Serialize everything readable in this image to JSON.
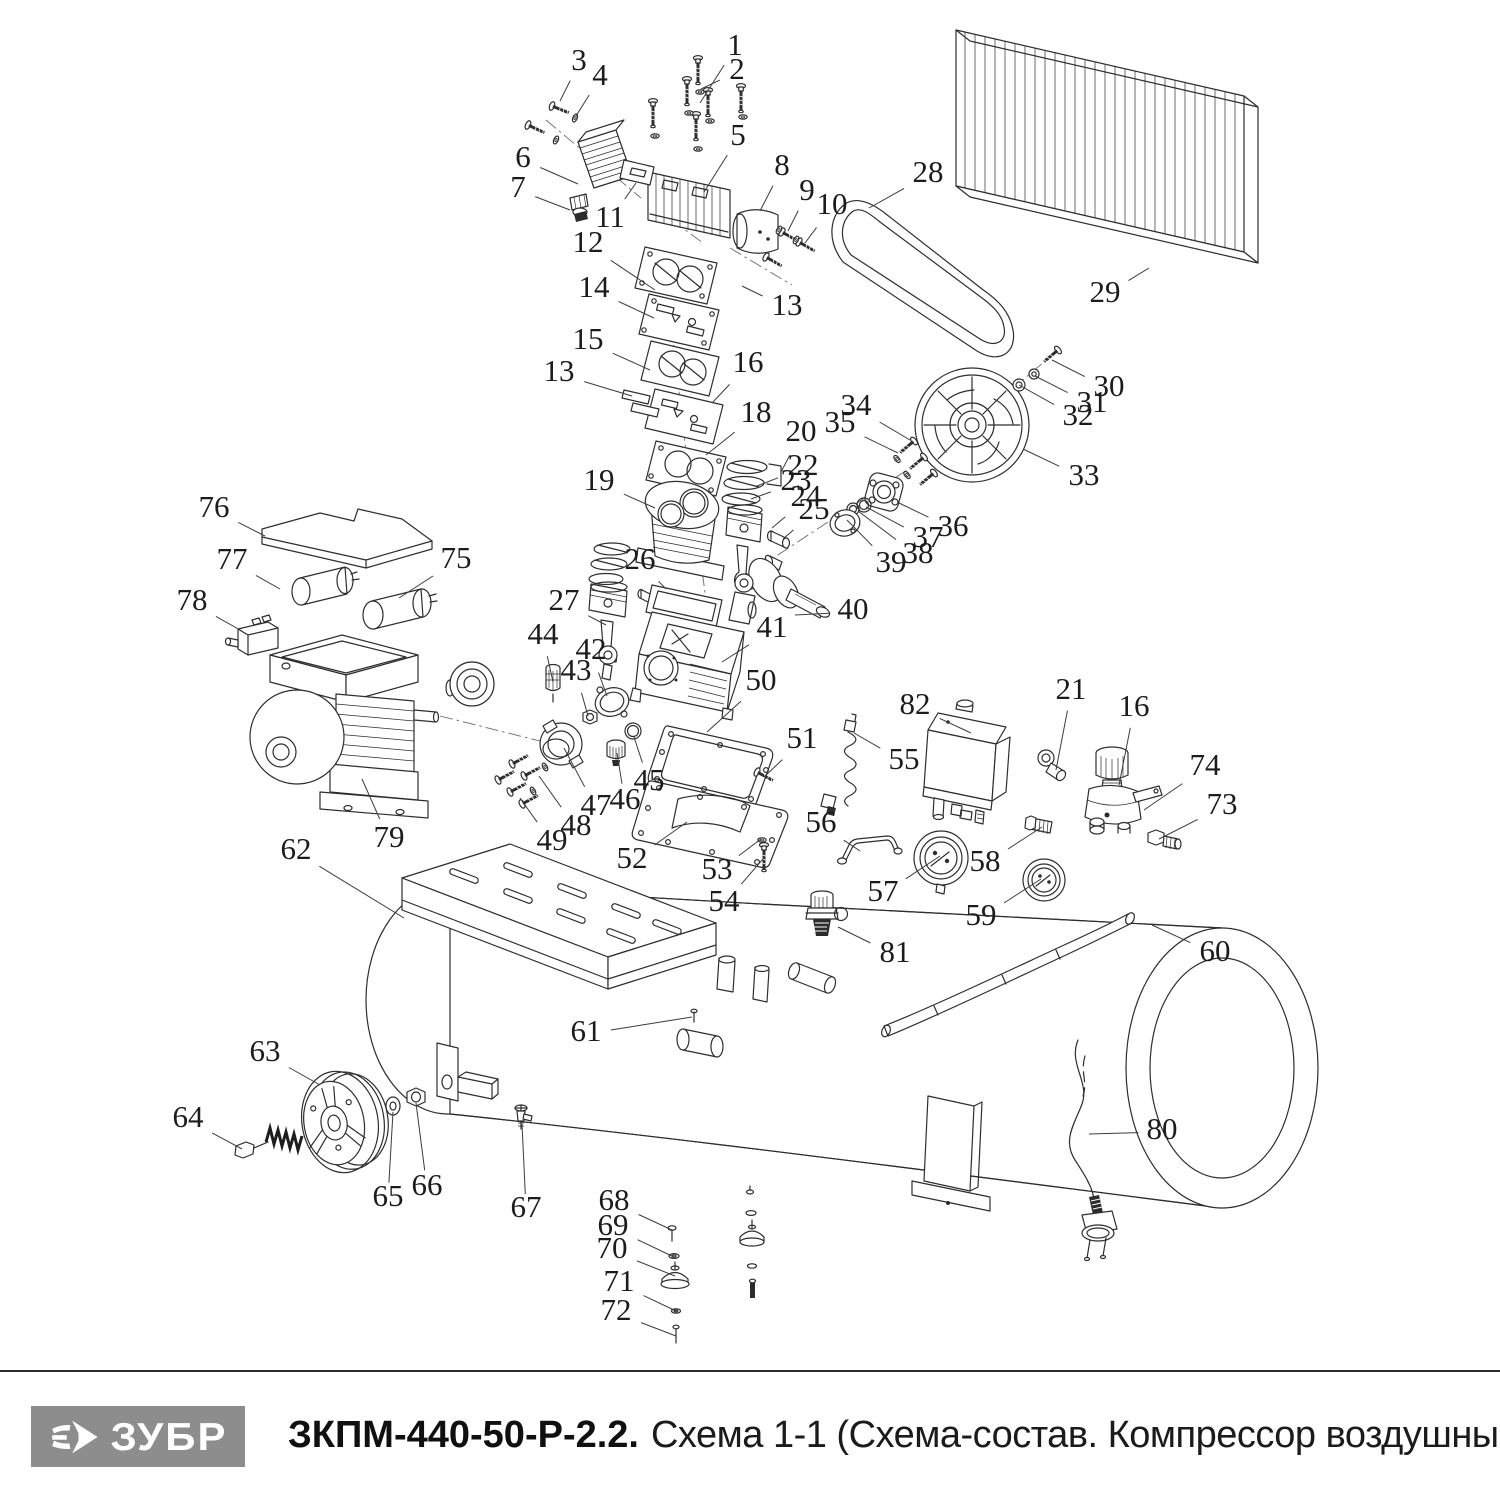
{
  "footer": {
    "brand": "ЗУБР",
    "model": "ЗКПМ-440-50-Р-2.2.",
    "subtitle": "Схема 1-1 (Схема-состав. Компрессор воздушный)",
    "brand_bg": "#8d8d8d",
    "divider_color": "#2b2b2b"
  },
  "diagram": {
    "ink": "#2e2e2e",
    "label_color": "#1c1c1c",
    "label_font_size": 31,
    "labels": [
      {
        "n": "1",
        "x": 735,
        "y": 48,
        "ax": 700,
        "ay": 103
      },
      {
        "n": "2",
        "x": 737,
        "y": 72,
        "ax": 701,
        "ay": 89
      },
      {
        "n": "3",
        "x": 579,
        "y": 63,
        "ax": 560,
        "ay": 101
      },
      {
        "n": "4",
        "x": 600,
        "y": 78,
        "ax": 576,
        "ay": 116
      },
      {
        "n": "5",
        "x": 738,
        "y": 138,
        "ax": 704,
        "ay": 192
      },
      {
        "n": "6",
        "x": 523,
        "y": 160,
        "ax": 578,
        "ay": 184
      },
      {
        "n": "7",
        "x": 518,
        "y": 190,
        "ax": 570,
        "ay": 210
      },
      {
        "n": "8",
        "x": 782,
        "y": 168,
        "ax": 760,
        "ay": 211
      },
      {
        "n": "9",
        "x": 807,
        "y": 193,
        "ax": 788,
        "ay": 231
      },
      {
        "n": "10",
        "x": 832,
        "y": 207,
        "ax": 805,
        "ay": 243
      },
      {
        "n": "11",
        "x": 610,
        "y": 220,
        "ax": 636,
        "ay": 183
      },
      {
        "n": "12",
        "x": 588,
        "y": 245,
        "ax": 655,
        "ay": 290
      },
      {
        "n": "13",
        "x": 787,
        "y": 308,
        "ax": 742,
        "ay": 286
      },
      {
        "n": "14",
        "x": 594,
        "y": 290,
        "ax": 654,
        "ay": 318
      },
      {
        "n": "15",
        "x": 588,
        "y": 342,
        "ax": 650,
        "ay": 370
      },
      {
        "n": "16",
        "x": 748,
        "y": 365,
        "ax": 712,
        "ay": 403
      },
      {
        "n": "13",
        "x": 559,
        "y": 374,
        "ax": 632,
        "ay": 396
      },
      {
        "n": "18",
        "x": 756,
        "y": 415,
        "ax": 706,
        "ay": 455
      },
      {
        "n": "19",
        "x": 599,
        "y": 483,
        "ax": 655,
        "ay": 508
      },
      {
        "n": "20",
        "x": 801,
        "y": 434,
        "ax": 781,
        "ay": 472
      },
      {
        "n": "22",
        "x": 803,
        "y": 468,
        "ax": 757,
        "ay": 486
      },
      {
        "n": "23",
        "x": 796,
        "y": 483,
        "ax": 751,
        "ay": 499
      },
      {
        "n": "24",
        "x": 806,
        "y": 499,
        "ax": 772,
        "ay": 528
      },
      {
        "n": "25",
        "x": 814,
        "y": 512,
        "ax": 783,
        "ay": 539
      },
      {
        "n": "26",
        "x": 640,
        "y": 562,
        "ax": 666,
        "ay": 589
      },
      {
        "n": "27",
        "x": 564,
        "y": 603,
        "ax": 606,
        "ay": 625
      },
      {
        "n": "28",
        "x": 928,
        "y": 175,
        "ax": 869,
        "ay": 208
      },
      {
        "n": "29",
        "x": 1105,
        "y": 295,
        "ax": 1149,
        "ay": 268
      },
      {
        "n": "30",
        "x": 1109,
        "y": 389,
        "ax": 1052,
        "ay": 360
      },
      {
        "n": "31",
        "x": 1092,
        "y": 405,
        "ax": 1035,
        "ay": 376
      },
      {
        "n": "32",
        "x": 1078,
        "y": 418,
        "ax": 1019,
        "ay": 385
      },
      {
        "n": "33",
        "x": 1084,
        "y": 478,
        "ax": 1023,
        "ay": 449
      },
      {
        "n": "34",
        "x": 856,
        "y": 408,
        "ax": 910,
        "ay": 440
      },
      {
        "n": "35",
        "x": 840,
        "y": 425,
        "ax": 898,
        "ay": 453
      },
      {
        "n": "36",
        "x": 953,
        "y": 529,
        "ax": 899,
        "ay": 503
      },
      {
        "n": "37",
        "x": 928,
        "y": 540,
        "ax": 866,
        "ay": 507
      },
      {
        "n": "38",
        "x": 918,
        "y": 556,
        "ax": 858,
        "ay": 511
      },
      {
        "n": "39",
        "x": 891,
        "y": 565,
        "ax": 847,
        "ay": 520
      },
      {
        "n": "40",
        "x": 853,
        "y": 612,
        "ax": 795,
        "ay": 615
      },
      {
        "n": "41",
        "x": 772,
        "y": 630,
        "ax": 722,
        "ay": 662
      },
      {
        "n": "42",
        "x": 591,
        "y": 652,
        "ax": 607,
        "ay": 696
      },
      {
        "n": "43",
        "x": 576,
        "y": 673,
        "ax": 588,
        "ay": 716
      },
      {
        "n": "44",
        "x": 543,
        "y": 637,
        "ax": 553,
        "ay": 682
      },
      {
        "n": "45",
        "x": 649,
        "y": 783,
        "ax": 634,
        "ay": 737
      },
      {
        "n": "46",
        "x": 625,
        "y": 802,
        "ax": 617,
        "ay": 753
      },
      {
        "n": "47",
        "x": 596,
        "y": 808,
        "ax": 564,
        "ay": 748
      },
      {
        "n": "48",
        "x": 576,
        "y": 828,
        "ax": 539,
        "ay": 776
      },
      {
        "n": "49",
        "x": 552,
        "y": 843,
        "ax": 520,
        "ay": 798
      },
      {
        "n": "50",
        "x": 761,
        "y": 683,
        "ax": 707,
        "ay": 732
      },
      {
        "n": "51",
        "x": 802,
        "y": 741,
        "ax": 764,
        "ay": 777
      },
      {
        "n": "52",
        "x": 632,
        "y": 861,
        "ax": 687,
        "ay": 822
      },
      {
        "n": "53",
        "x": 717,
        "y": 872,
        "ax": 761,
        "ay": 839
      },
      {
        "n": "54",
        "x": 724,
        "y": 904,
        "ax": 763,
        "ay": 859
      },
      {
        "n": "55",
        "x": 904,
        "y": 762,
        "ax": 854,
        "ay": 733
      },
      {
        "n": "56",
        "x": 821,
        "y": 825,
        "ax": 860,
        "ay": 851
      },
      {
        "n": "57",
        "x": 883,
        "y": 894,
        "ax": 940,
        "ay": 856
      },
      {
        "n": "58",
        "x": 985,
        "y": 864,
        "ax": 1042,
        "ay": 827
      },
      {
        "n": "59",
        "x": 981,
        "y": 918,
        "ax": 1041,
        "ay": 879
      },
      {
        "n": "60",
        "x": 1215,
        "y": 954,
        "ax": 1152,
        "ay": 925
      },
      {
        "n": "61",
        "x": 586,
        "y": 1034,
        "ax": 692,
        "ay": 1017
      },
      {
        "n": "62",
        "x": 296,
        "y": 852,
        "ax": 404,
        "ay": 918
      },
      {
        "n": "63",
        "x": 265,
        "y": 1054,
        "ax": 320,
        "ay": 1085
      },
      {
        "n": "64",
        "x": 188,
        "y": 1120,
        "ax": 242,
        "ay": 1149
      },
      {
        "n": "65",
        "x": 388,
        "y": 1199,
        "ax": 393,
        "ay": 1112
      },
      {
        "n": "66",
        "x": 427,
        "y": 1188,
        "ax": 416,
        "ay": 1103
      },
      {
        "n": "67",
        "x": 526,
        "y": 1210,
        "ax": 522,
        "ay": 1124
      },
      {
        "n": "68",
        "x": 614,
        "y": 1203,
        "ax": 672,
        "ay": 1230
      },
      {
        "n": "69",
        "x": 613,
        "y": 1228,
        "ax": 674,
        "ay": 1257
      },
      {
        "n": "70",
        "x": 612,
        "y": 1251,
        "ax": 675,
        "ay": 1276
      },
      {
        "n": "71",
        "x": 619,
        "y": 1284,
        "ax": 676,
        "ay": 1311
      },
      {
        "n": "72",
        "x": 616,
        "y": 1313,
        "ax": 676,
        "ay": 1336
      },
      {
        "n": "73",
        "x": 1222,
        "y": 807,
        "ax": 1159,
        "ay": 839
      },
      {
        "n": "74",
        "x": 1205,
        "y": 768,
        "ax": 1144,
        "ay": 810
      },
      {
        "n": "75",
        "x": 456,
        "y": 561,
        "ax": 399,
        "ay": 598
      },
      {
        "n": "76",
        "x": 214,
        "y": 510,
        "ax": 265,
        "ay": 536
      },
      {
        "n": "77",
        "x": 232,
        "y": 562,
        "ax": 280,
        "ay": 589
      },
      {
        "n": "78",
        "x": 192,
        "y": 603,
        "ax": 242,
        "ay": 631
      },
      {
        "n": "79",
        "x": 389,
        "y": 840,
        "ax": 362,
        "ay": 779
      },
      {
        "n": "80",
        "x": 1162,
        "y": 1132,
        "ax": 1089,
        "ay": 1134
      },
      {
        "n": "81",
        "x": 895,
        "y": 955,
        "ax": 838,
        "ay": 927
      },
      {
        "n": "82",
        "x": 915,
        "y": 707,
        "ax": 971,
        "ay": 733
      },
      {
        "n": "16",
        "x": 1134,
        "y": 709,
        "ax": 1119,
        "ay": 785
      },
      {
        "n": "21",
        "x": 1071,
        "y": 692,
        "ax": 1056,
        "ay": 770
      }
    ]
  }
}
